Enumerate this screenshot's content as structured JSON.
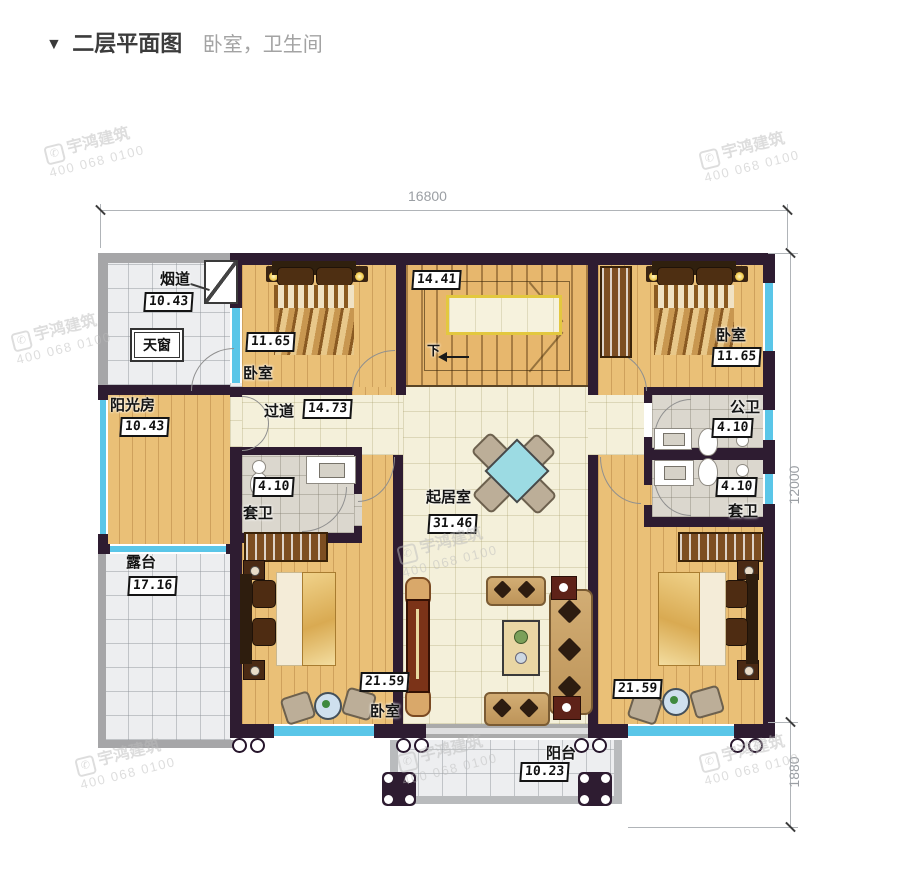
{
  "header": {
    "marker": "▼",
    "title": "二层平面图",
    "subtitle": "卧室，卫生间"
  },
  "dimensions": {
    "width_total": "16800",
    "height_main": "12000",
    "height_balcony": "1880"
  },
  "watermark": {
    "brand": "宇鸿建筑",
    "phone": "400 068 0100"
  },
  "rooms": {
    "flue": {
      "name": "烟道",
      "area": "10.43"
    },
    "skylight": {
      "name": "天窗"
    },
    "sunroom": {
      "name": "阳光房",
      "area": "10.43"
    },
    "terrace": {
      "name": "露台",
      "area": "17.16"
    },
    "bedroom_top_left": {
      "name": "卧室",
      "area": "11.65"
    },
    "bedroom_top_right": {
      "name": "卧室",
      "area": "11.65"
    },
    "stairs": {
      "area": "14.41",
      "down_label": "下"
    },
    "corridor": {
      "name": "过道",
      "area": "14.73"
    },
    "living_room": {
      "name": "起居室",
      "area": "31.46"
    },
    "public_bath": {
      "name": "公卫",
      "area": "4.10"
    },
    "ensuite_left": {
      "name": "套卫",
      "area": "4.10"
    },
    "ensuite_right": {
      "name": "套卫",
      "area": "4.10"
    },
    "bedroom_bottom_left": {
      "name": "卧室",
      "area": "21.59"
    },
    "bedroom_bottom_right": {
      "name": "卧室",
      "area": "21.59"
    },
    "balcony": {
      "name": "阳台",
      "area": "10.23"
    }
  }
}
